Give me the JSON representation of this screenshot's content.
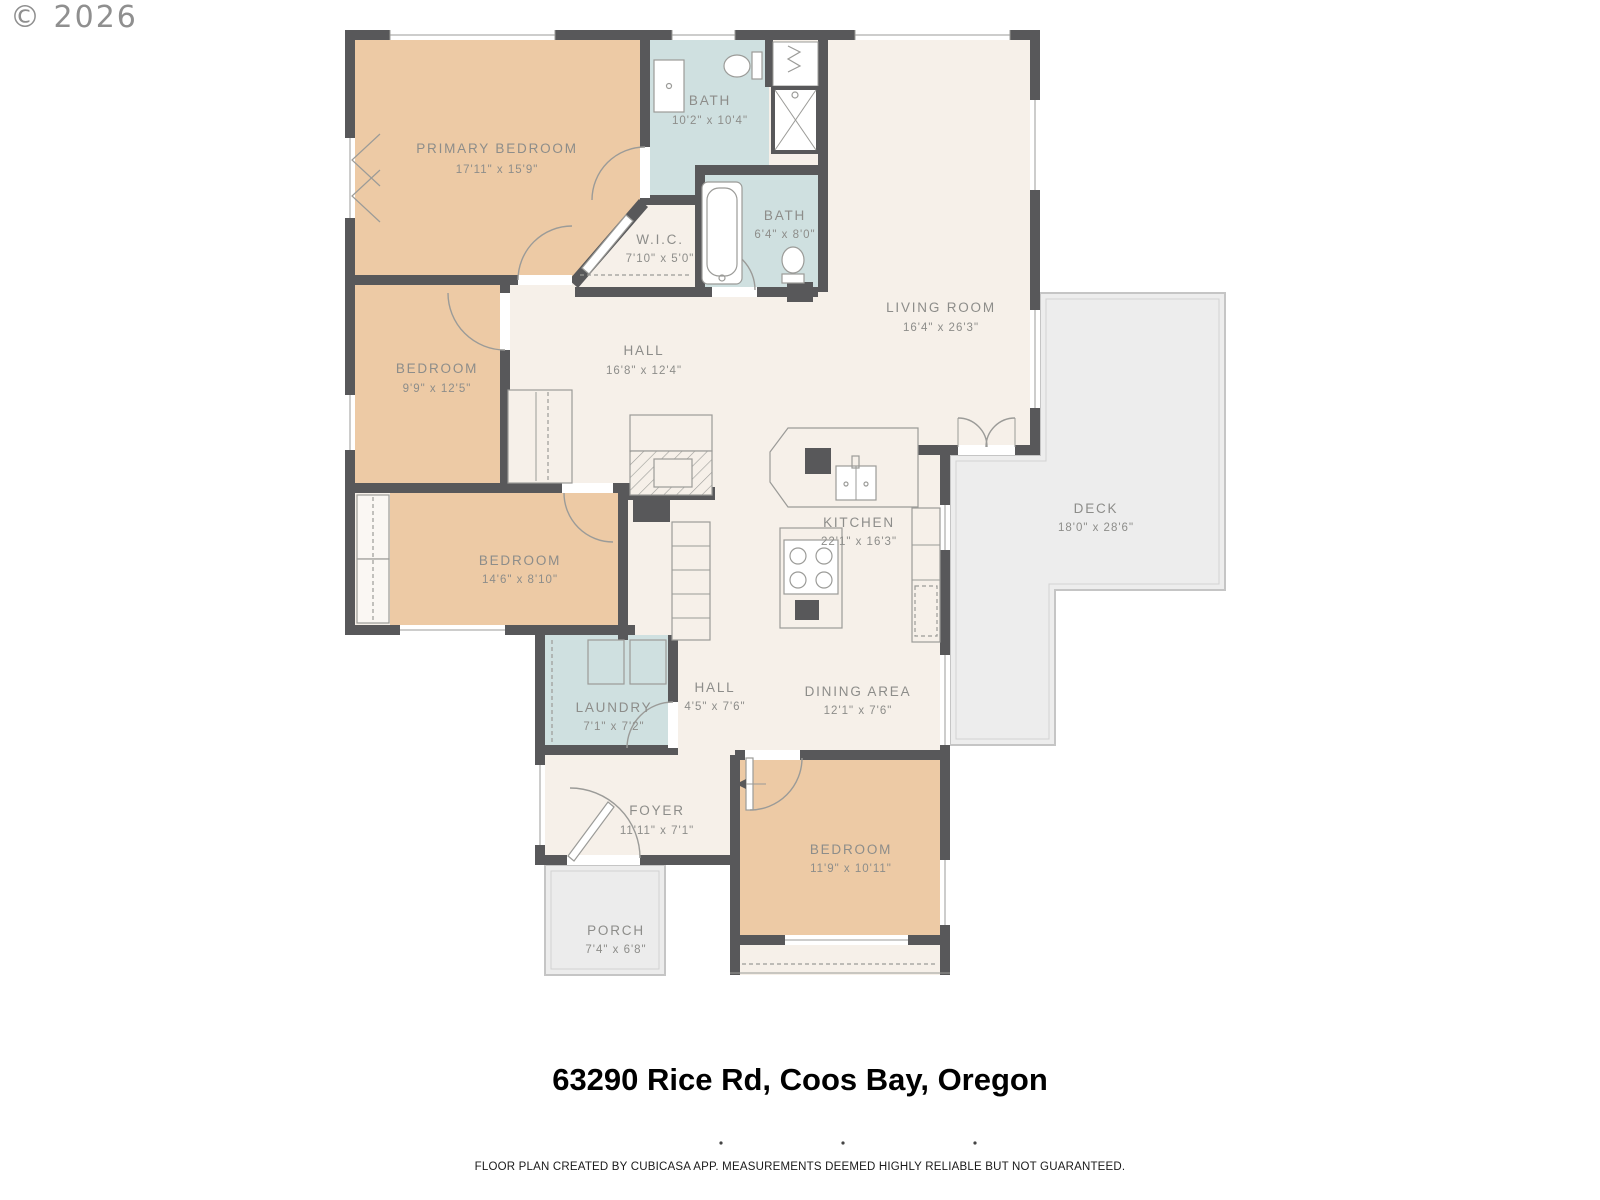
{
  "copyright": "© 2026",
  "title": "63290 Rice Rd, Coos Bay, Oregon",
  "disclaimer": "FLOOR PLAN CREATED BY CUBICASA APP. MEASUREMENTS DEEMED HIGHLY RELIABLE BUT NOT GUARANTEED.",
  "colors": {
    "wall": "#58585a",
    "floor": "#f6f0e9",
    "bedroom": "#edcaa5",
    "bath": "#cfe0e0",
    "deck": "#ededed",
    "label": "#8d8d8a"
  },
  "rooms": {
    "primary_bedroom": {
      "name": "PRIMARY BEDROOM",
      "dims": "17'11\" x 15'9\""
    },
    "bath_upper": {
      "name": "BATH",
      "dims": "10'2\" x 10'4\""
    },
    "wic": {
      "name": "W.I.C.",
      "dims": "7'10\" x 5'0\""
    },
    "bath_lower": {
      "name": "BATH",
      "dims": "6'4\" x 8'0\""
    },
    "living_room": {
      "name": "LIVING ROOM",
      "dims": "16'4\" x 26'3\""
    },
    "bedroom_left": {
      "name": "BEDROOM",
      "dims": "9'9\" x 12'5\""
    },
    "hall_main": {
      "name": "HALL",
      "dims": "16'8\" x 12'4\""
    },
    "kitchen": {
      "name": "KITCHEN",
      "dims": "22'1\" x 16'3\""
    },
    "deck": {
      "name": "DECK",
      "dims": "18'0\" x 28'6\""
    },
    "bedroom_mid": {
      "name": "BEDROOM",
      "dims": "14'6\" x 8'10\""
    },
    "laundry": {
      "name": "LAUNDRY",
      "dims": "7'1\" x 7'2\""
    },
    "hall_small": {
      "name": "HALL",
      "dims": "4'5\" x 7'6\""
    },
    "dining": {
      "name": "DINING AREA",
      "dims": "12'1\" x 7'6\""
    },
    "foyer": {
      "name": "FOYER",
      "dims": "11'11\" x 7'1\""
    },
    "bedroom_front": {
      "name": "BEDROOM",
      "dims": "11'9\" x 10'11\""
    },
    "porch": {
      "name": "PORCH",
      "dims": "7'4\" x 6'8\""
    }
  }
}
